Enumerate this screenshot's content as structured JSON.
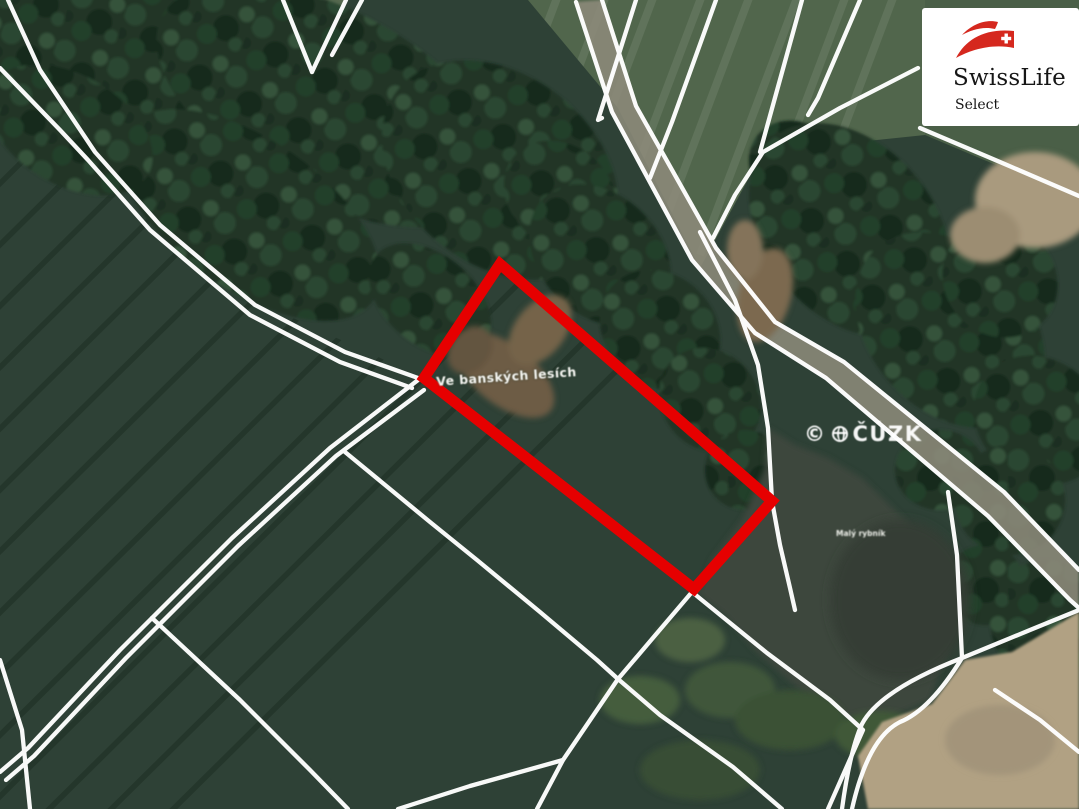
{
  "map": {
    "field_label": "Ve banských lesích",
    "pond_label": "Malý rybník",
    "watermark": {
      "copyright": "©",
      "text": "ČÚZK"
    },
    "colors": {
      "parcel_highlight_red": "#e60000",
      "cadastre_line_white": "#ffffff",
      "field_green": "#2e4136",
      "forest_green": "#223425",
      "water_gray_green": "#3e463c",
      "road_tan": "#8d8a7a",
      "bare_soil_tan": "#b1a183"
    }
  },
  "logo": {
    "title": "SwissLife",
    "subtitle": "Select",
    "brand_red": "#d5281e"
  }
}
